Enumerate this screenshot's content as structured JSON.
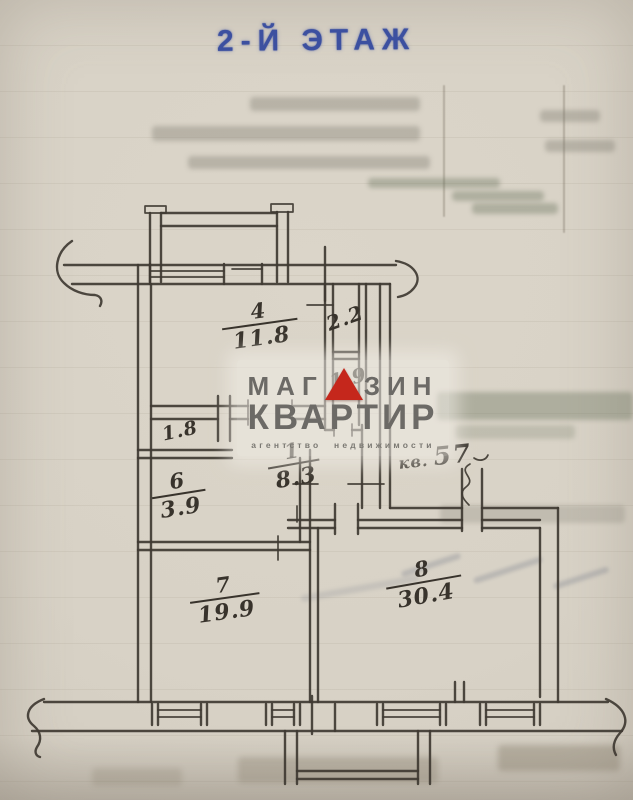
{
  "page": {
    "title_stamp": "2-Й ЭТАЖ"
  },
  "watermark": {
    "brand_left": "МАГ",
    "brand_right": "ЗИН",
    "brand_bottom": "КВАРТИР",
    "tagline": "агентство недвижимости",
    "triangle_icon": "red-triangle"
  },
  "entrance": {
    "prefix": "кв.",
    "apartment_number": "57"
  },
  "rooms": {
    "r4": {
      "number": "4",
      "area": "11.8"
    },
    "r22": {
      "area": "2.2"
    },
    "r19": {
      "area": "1.9"
    },
    "r1": {
      "number": "1",
      "area": "8.3"
    },
    "r18": {
      "area": "1.8"
    },
    "r6": {
      "number": "6",
      "area": "3.9"
    },
    "r7": {
      "number": "7",
      "area": "19.9"
    },
    "r8": {
      "number": "8",
      "area": "30.4"
    }
  },
  "colors": {
    "stamp_blue": "#3c50a0",
    "pencil": "#3f3a32",
    "paper": "#d8d2c6",
    "logo_gray": "#6c6a66",
    "logo_red": "#c5271c"
  }
}
